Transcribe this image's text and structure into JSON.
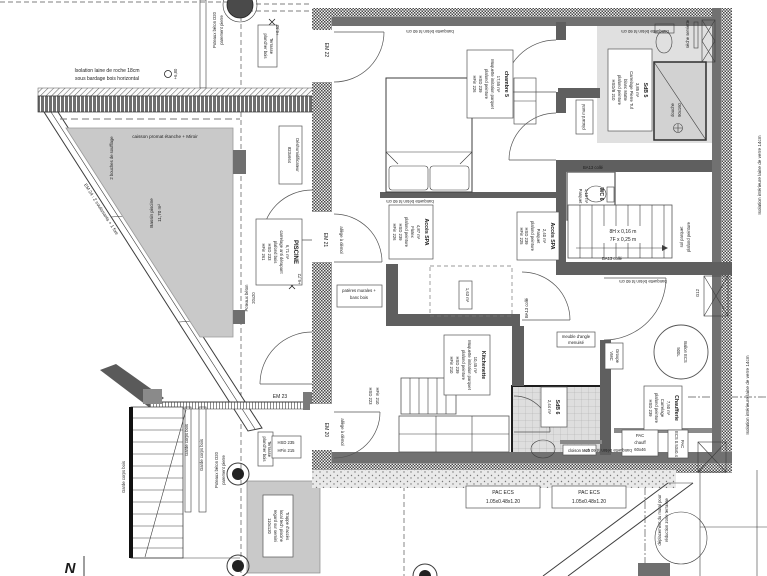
{
  "drawing": {
    "colors": {
      "wall_solid": "#717171",
      "wall_checker": "#4a4a4a",
      "floor_gray": "#e0e0e0",
      "basin_gray": "#c9c9c9",
      "line": "#3d3d3d"
    },
    "annotations": {
      "iso_roche1": "Isolation laine de roche 18cm",
      "iso_roche2": "sous bardage bois horizontal",
      "lvl680": "+6,80",
      "lvl662": "+6,62",
      "lvl672": "+6,72",
      "caisson": "caisson promat étanche + Miroir",
      "bouches": "2 bouches de soufflage",
      "bassin1": "Bassin piscine",
      "bassin2": "11,70 m²",
      "pot_d20a": "Poteaux béton D20",
      "pot_d20b": "parement pierre",
      "pot2020a": "Poteaux béton",
      "pot2020b": "20x20",
      "terr1": "Terrasse",
      "terr2": "plancher bois",
      "deshu1": "Déshumidificateur",
      "deshu2": "823x664",
      "banquette": "banquette béton ht 60 cm",
      "allege": "allège à démol",
      "pateres1": "patères murales +",
      "pateres2": "banc bois",
      "stair1": "8H x 0,16 m",
      "stair2": "7F x 0,25 m",
      "ba13": "BA13 collé",
      "solparquet": "sol parquet",
      "plafpeint": "plafond peinture",
      "g12": "G12",
      "cloison": "cloison tech",
      "douche1": "douche",
      "douche2": "90x160",
      "seche": "sèche serviette",
      "placard": "placard mural",
      "closet_area": "1,63 m²",
      "isoint": "Isolation intérieure laine de verre 14cm",
      "garde": "Garde corps bois",
      "trappe1": "Trappe d'accès",
      "trappe2": "local tech piscine",
      "trappe3": "regard sur semini",
      "trappe4": "110x120",
      "depl1": "déplacement du mural pour",
      "depl2": "réduction zone terrasse",
      "hsd223a": "HSD 223",
      "hsd223b": "HFin 210",
      "hsd235a": "HSD 235",
      "hsd235b": "HFin 215",
      "north": "N"
    },
    "openings": {
      "em20": "EM 20",
      "em21": "EM 21",
      "em22": "EM 22",
      "em23": "EM 23",
      "em24": "EM 24 : 2 coulissants + 1 fixe"
    },
    "rooms": {
      "piscine": {
        "title": "PISCINE",
        "area": "6,71 m²",
        "l1": "carrelage anti dérapant",
        "l2": "plafond bois",
        "l3": "HSD 233",
        "l4": "HFin 261"
      },
      "spa1": {
        "title": "Accès SPA",
        "area": "4,87 m²",
        "l1": "Flotex",
        "l2": "plafond peinture",
        "l3": "HSD 239",
        "l4": "HFin 226"
      },
      "spa2": {
        "title": "Accès SPA",
        "area": "2,40 m²",
        "l1": "Parquet",
        "l2": "plafond peinture",
        "l3": "HSD 239",
        "l4": "HFin 225"
      },
      "ch5": {
        "title": "chambre 5",
        "area": "17,55 m²",
        "l1": "Moquette imitation parquet",
        "l2": "plafond peinture",
        "l3": "HSD 239",
        "l4": "HFin 226"
      },
      "sdb5": {
        "title": "SdB 5",
        "area": "3,85 m²",
        "l1": "Carrelage Pierre Tuf",
        "l2": "blanc Matte",
        "l3": "plafond peinture",
        "l4": "HSD/B 210"
      },
      "kitch": {
        "title": "Kitchenette",
        "area": "10,45 m²",
        "l1": "Moquette imitation parquet",
        "l2": "plafond peinture",
        "l3": "HSD 239",
        "l4": "HFin 210"
      },
      "sdb6": {
        "title": "SdB 6",
        "area": "2,44 m²"
      },
      "chauf": {
        "title": "Chaufferie",
        "area": "7,50 m²",
        "l1": "Carrelage",
        "l2": "plafond peinture",
        "l3": "HSD 239"
      },
      "wc6": {
        "title": "WC 6",
        "area": "1,10 m²",
        "l1": "Parquet"
      }
    },
    "equipment": {
      "ballon1": "Ballon ECS",
      "ballon2": "500L",
      "vmc1": "Groupe",
      "vmc2": "VMC",
      "meuble1": "meuble d'angle",
      "meuble2": "menuisé",
      "pacch1": "PAC",
      "pacch2": "chauff",
      "pacch3": "60x46",
      "pacecs1": "PAC",
      "pacecs2": "ECS 0.53x0.4",
      "pacbox1": "PAC ECS",
      "pacbox2": "1.05x0.48x1.20"
    }
  }
}
